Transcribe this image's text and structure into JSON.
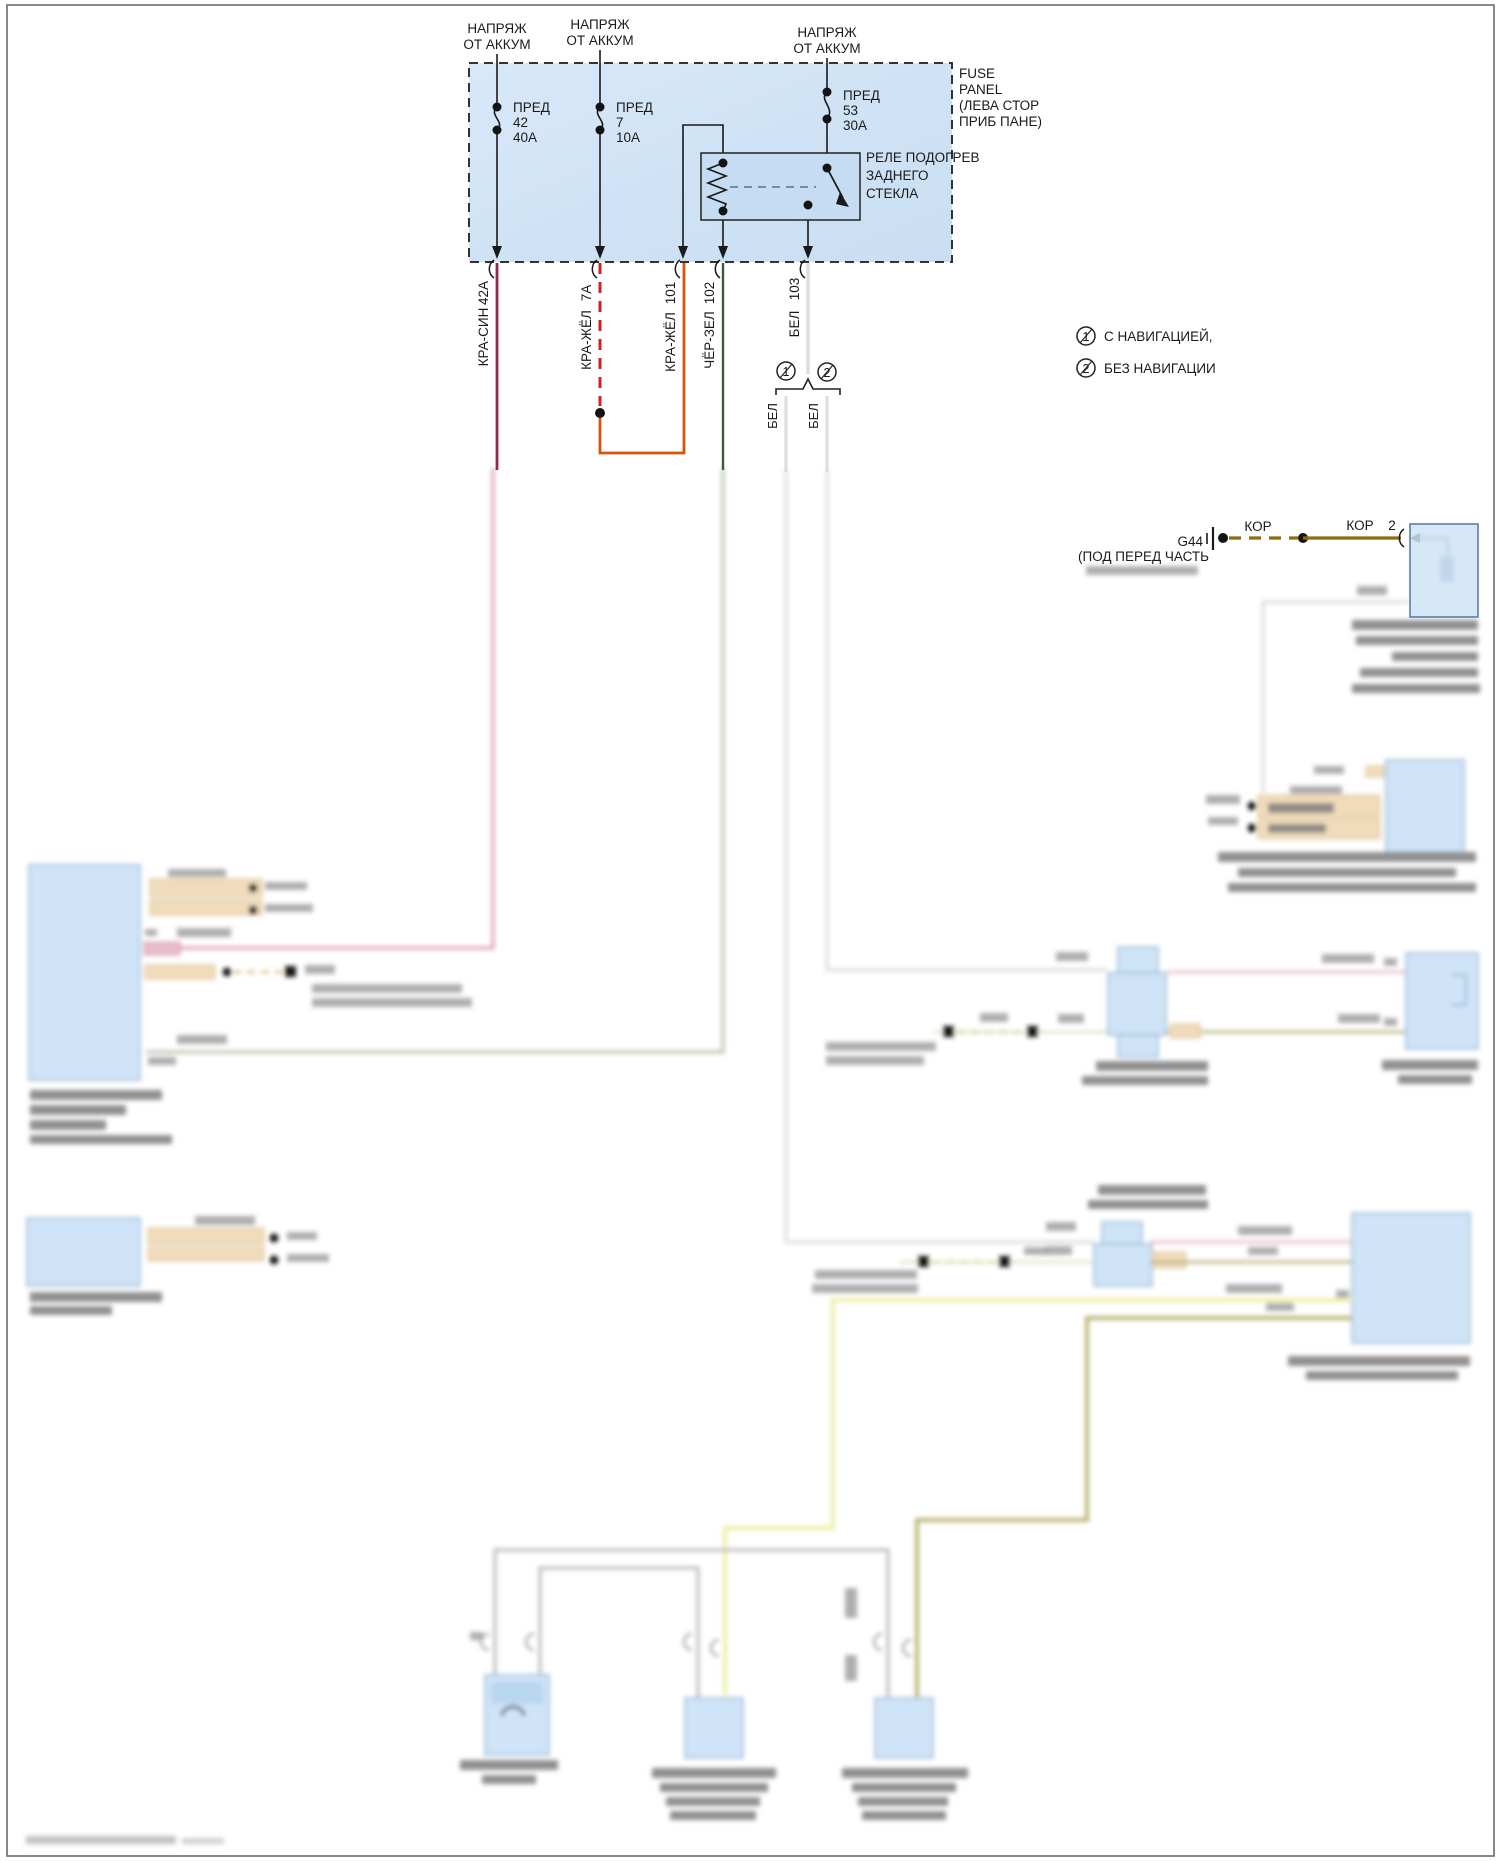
{
  "colors": {
    "panel_fill_light": "#ddebfa",
    "panel_fill": "#cfe3f6",
    "relay_fill": "#c6dcf2",
    "wire_kra_sin": "#8f2a4a",
    "wire_kra_sin_blur": "#e099b5",
    "wire_kra_zhel_dash": "#cc2222",
    "wire_kra_zhel": "#d8540e",
    "wire_cher_zel": "#3c5a36",
    "wire_cher_zel_blur": "#b8c0b0",
    "wire_bel": "#e0e0e0",
    "wire_kor": "#8a6d10",
    "wire_yellow": "#efefae",
    "wire_khaki": "#b2aa5e",
    "wire_gray": "#c2c2c2",
    "wire_pink": "#e6b6c4",
    "wire_olive": "#b4ad72"
  },
  "feeds": [
    {
      "l1": "НАПРЯЖ",
      "l2": "ОТ АККУМ"
    },
    {
      "l1": "НАПРЯЖ",
      "l2": "ОТ АККУМ"
    },
    {
      "l1": "НАПРЯЖ",
      "l2": "ОТ АККУМ"
    }
  ],
  "panel": {
    "l1": "FUSE",
    "l2": "PANEL",
    "l3": "(ЛЕВА СТОР",
    "l4": "ПРИБ ПАНЕ)"
  },
  "fuses": [
    {
      "name": "ПРЕД",
      "num": "42",
      "amps": "40А"
    },
    {
      "name": "ПРЕД",
      "num": "7",
      "amps": "10А"
    },
    {
      "name": "ПРЕД",
      "num": "53",
      "amps": "30А"
    }
  ],
  "relay": {
    "l1": "РЕЛЕ ПОДОГРЕВ",
    "l2": "ЗАДНЕГО",
    "l3": "СТЕКЛА"
  },
  "wires": [
    {
      "color": "КРА-СИН",
      "circuit": "42А"
    },
    {
      "color": "КРА-ЖЁЛ",
      "circuit": "7А"
    },
    {
      "color": "КРА-ЖЁЛ",
      "circuit": "101"
    },
    {
      "color": "ЧЁР-ЗЕЛ",
      "circuit": "102"
    },
    {
      "color": "БЕЛ",
      "circuit": "103"
    }
  ],
  "branches": [
    {
      "num": "1",
      "wire": "БЕЛ"
    },
    {
      "num": "2",
      "wire": "БЕЛ"
    }
  ],
  "notes": [
    {
      "num": "1",
      "text": "С НАВИГАЦИЕЙ,"
    },
    {
      "num": "2",
      "text": "БЕЗ НАВИГАЦИИ"
    }
  ],
  "ground": {
    "id": "G44",
    "location": "(ПОД ПЕРЕД ЧАСТЬ",
    "wire1": "КОР",
    "wire2": "КОР",
    "pin": "2"
  }
}
